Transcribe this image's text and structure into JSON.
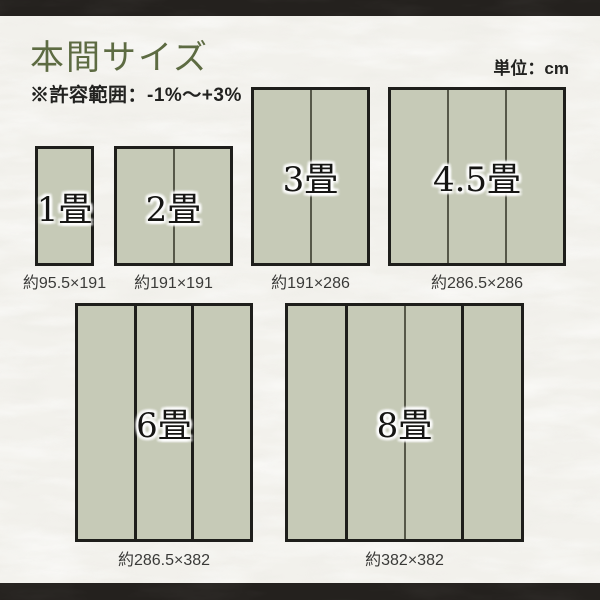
{
  "page": {
    "title": "本間サイズ",
    "tolerance_note": "※許容範囲：-1%〜+3%",
    "unit_label": "単位：cm"
  },
  "colors": {
    "paper_background": "#f2f1ec",
    "frame_bar": "#24211e",
    "title_green": "#5d6b42",
    "mat_fill": "#c6cab7",
    "mat_border": "#1e1e1b",
    "divider_thin_gray": "#565849",
    "text_dark": "#222220"
  },
  "mats": [
    {
      "label": "1畳",
      "dimensions": "約95.5×191"
    },
    {
      "label": "2畳",
      "dimensions": "約191×191"
    },
    {
      "label": "3畳",
      "dimensions": "約191×286"
    },
    {
      "label": "4.5畳",
      "dimensions": "約286.5×286"
    },
    {
      "label": "6畳",
      "dimensions": "約286.5×382"
    },
    {
      "label": "8畳",
      "dimensions": "約382×382"
    }
  ]
}
